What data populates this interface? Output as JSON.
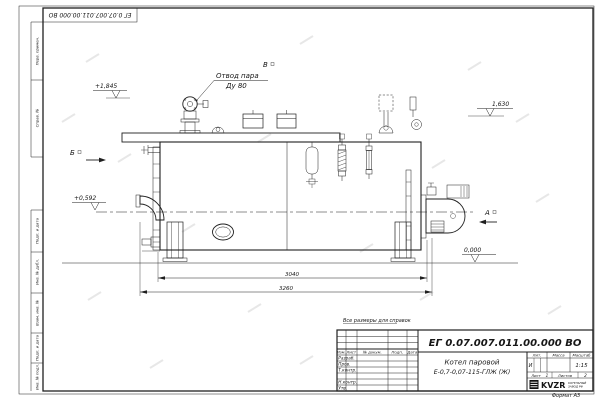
{
  "sheet": {
    "top_designation": "ЕГ 0.07.007.011.00.000  ВО",
    "format_note": "Формат А3"
  },
  "margin": {
    "cells_top": [
      "Перв. примен.",
      "Справ. №"
    ],
    "cells_bottom": [
      "Подп. и дата",
      "Инв. № дубл.",
      "Взам. инв. №",
      "Подп. и дата",
      "Инв. № подл."
    ]
  },
  "drawing": {
    "steam_outlet_line1": "Отвод пара",
    "steam_outlet_line2": "Ду 80",
    "view_top": "В",
    "view_left": "Б",
    "view_right": "А",
    "elev_valve": "+1,845",
    "elev_drum": "1,630",
    "elev_axis": "+0,592",
    "elev_ground": "0,000",
    "dim_inner": "3040",
    "dim_outer": "3260"
  },
  "title_block": {
    "reference_note": "Все размеры для справок",
    "designation": "ЕГ 0.07.007.011.00.000  ВО",
    "product_line1": "Котел паровой",
    "product_line2": "Е-0,7-0,07-115-ГЛЖ (Ж)",
    "col_izm": "Изм.",
    "col_list": "Лист",
    "col_doc": "№ докум.",
    "col_sign": "Подп.",
    "col_date": "Дата",
    "row_razrab": "Разраб.",
    "row_prov": "Пров.",
    "row_tkontr": "Т.контр.",
    "row_nkontr": "Н.контр.",
    "row_utv": "Утв.",
    "lit_header": "Лит.",
    "lit_value": "И",
    "mass_header": "Масса",
    "scale_header": "Масштаб",
    "scale_value": "1:15",
    "sheet_header": "Лист",
    "sheet_value": "1",
    "sheets_header": "Листов",
    "sheets_value": "2",
    "company_logo": "KVZR",
    "company_line1": "КОТЕЛЬНЫЙ",
    "company_line2": "ЗАВОД РФ"
  }
}
